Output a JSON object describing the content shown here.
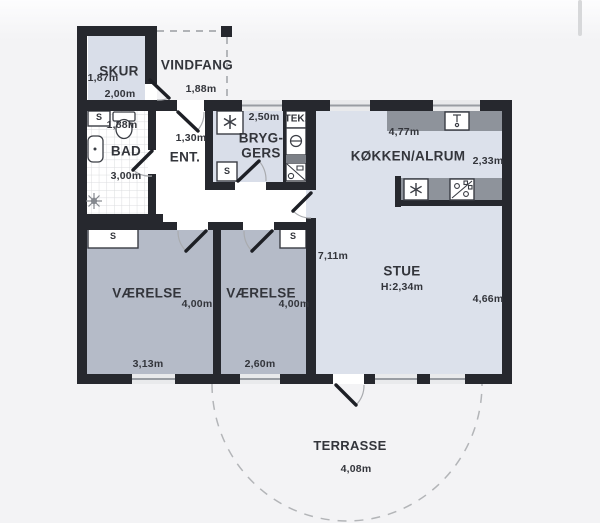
{
  "plan": {
    "rooms": {
      "skur": {
        "name": "SKUR",
        "dim_width": "1,87m",
        "dim_depth": "2,00m"
      },
      "vindfang": {
        "name": "VINDFANG",
        "dim_width": "1,88m"
      },
      "bad": {
        "name": "BAD",
        "closet": "S",
        "dim_width": "1,88m",
        "dim_depth": "3,00m"
      },
      "ent": {
        "name": "ENT.",
        "dim_width": "1,30m"
      },
      "hall": {
        "dim_length": "4,48m"
      },
      "bryggers": {
        "name_line1": "BRYG-",
        "name_line2": "GERS",
        "dim_width": "2,50m",
        "closet": "S",
        "tech_label": "TEK."
      },
      "koekken_alrum": {
        "name": "KØKKEN/ALRUM",
        "dim_width": "4,77m",
        "dim_depth": "2,33m"
      },
      "stue": {
        "name": "STUE",
        "ceiling_height": "H:2,34m",
        "dim_length": "7,11m",
        "dim_depth": "4,66m"
      },
      "vaerelse_1": {
        "name": "VÆRELSE",
        "dim_area": "4,00m",
        "dim_width": "3,13m",
        "closet": "S"
      },
      "vaerelse_2": {
        "name": "VÆRELSE",
        "dim_area": "4,00m",
        "dim_width": "2,60m",
        "closet": "S"
      },
      "terrasse": {
        "name": "TERRASSE",
        "dim_width": "4,08m"
      }
    },
    "icons": [
      "snowflake-vent-icon",
      "snowflake-freezer-icon",
      "stove-icon",
      "kitchen-sink-icon",
      "washing-machine-icon",
      "laundry-sink-icon",
      "toilet-icon",
      "bathroom-sink-icon",
      "shower-icon"
    ],
    "colors": {
      "wall": "#26282e",
      "room_light": "#d9dee9",
      "room_dark": "#b5bbc8",
      "counter_gray": "#8e939b",
      "background": "#f4f4f6",
      "text": "#33353b"
    }
  }
}
